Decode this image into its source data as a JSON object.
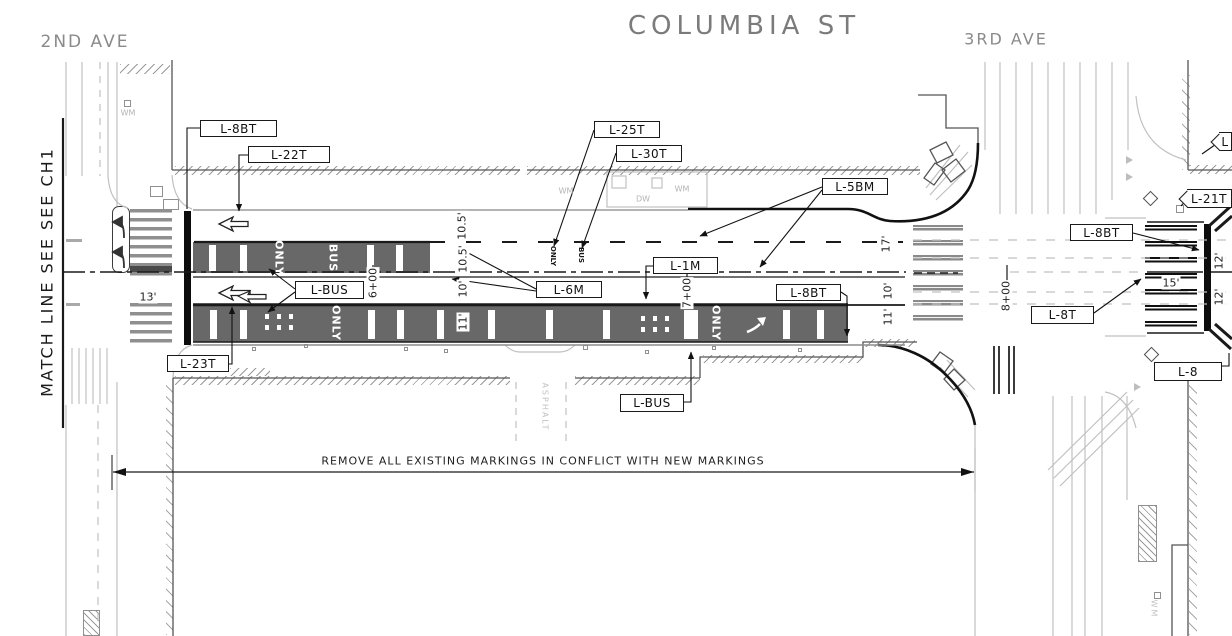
{
  "title": {
    "text": "COLUMBIA ST"
  },
  "streets": {
    "left": "2ND AVE",
    "right": "3RD AVE"
  },
  "match_line_label": "MATCH LINE SEE SEE CH1",
  "note": "REMOVE ALL EXISTING MARKINGS IN CONFLICT WITH NEW MARKINGS",
  "colors": {
    "ink": "#1a1a1a",
    "street_title_gray": "#7b7b7b",
    "existing_linework_gray": "#bcbcbc",
    "bus_lane_gray": "#686868",
    "paper": "#ffffff"
  },
  "marking_labels": [
    {
      "name": "label-l8bt-top",
      "shape": "rect",
      "text": "L-8BT",
      "x": 200,
      "y": 120,
      "w": 77,
      "h": 17
    },
    {
      "name": "label-l22t",
      "shape": "rect",
      "text": "L-22T",
      "x": 248,
      "y": 146,
      "w": 82,
      "h": 17
    },
    {
      "name": "label-l25t",
      "shape": "rect",
      "text": "L-25T",
      "x": 594,
      "y": 121,
      "w": 66,
      "h": 17
    },
    {
      "name": "label-l30t",
      "shape": "rect",
      "text": "L-30T",
      "x": 616,
      "y": 145,
      "w": 66,
      "h": 17
    },
    {
      "name": "label-l5bm",
      "shape": "rect",
      "text": "L-5BM",
      "x": 822,
      "y": 178,
      "w": 66,
      "h": 17
    },
    {
      "name": "label-l1m",
      "shape": "rect",
      "text": "L-1M",
      "x": 653,
      "y": 257,
      "w": 65,
      "h": 17
    },
    {
      "name": "label-l6m",
      "shape": "rect",
      "text": "L-6M",
      "x": 536,
      "y": 281,
      "w": 66,
      "h": 17
    },
    {
      "name": "label-lbus-mid",
      "shape": "rect",
      "text": "L-BUS",
      "x": 295,
      "y": 281,
      "w": 69,
      "h": 18
    },
    {
      "name": "label-l8bt-mid",
      "shape": "rect",
      "text": "L-8BT",
      "x": 776,
      "y": 284,
      "w": 65,
      "h": 17
    },
    {
      "name": "label-l23t",
      "shape": "rect",
      "text": "L-23T",
      "x": 167,
      "y": 355,
      "w": 62,
      "h": 17
    },
    {
      "name": "label-lbus-bottom",
      "shape": "rect",
      "text": "L-BUS",
      "x": 620,
      "y": 394,
      "w": 64,
      "h": 18
    },
    {
      "name": "label-l8bt-right",
      "shape": "rect",
      "text": "L-8BT",
      "x": 1070,
      "y": 224,
      "w": 63,
      "h": 17
    },
    {
      "name": "label-l8t",
      "shape": "rect",
      "text": "L-8T",
      "x": 1031,
      "y": 306,
      "w": 63,
      "h": 18
    },
    {
      "name": "label-l8",
      "shape": "rect",
      "text": "L-8",
      "x": 1154,
      "y": 362,
      "w": 68,
      "h": 19
    },
    {
      "name": "label-l21t-hex",
      "shape": "hex",
      "text": "L-21T",
      "x": 1187,
      "y": 189,
      "w": 45,
      "h": 19
    },
    {
      "name": "label-lhex-top",
      "shape": "hex",
      "text": "L",
      "x": 1219,
      "y": 132,
      "w": 13,
      "h": 19
    }
  ],
  "annotations": [
    {
      "name": "dim-10-5-a",
      "cls": "dim",
      "text": "10.5'",
      "x": 462,
      "y": 226
    },
    {
      "name": "dim-10-5-b",
      "cls": "dim",
      "text": "10.5'",
      "x": 463,
      "y": 259
    },
    {
      "name": "dim-10-a",
      "cls": "dim",
      "text": "10'",
      "x": 463,
      "y": 289
    },
    {
      "name": "dim-11-a",
      "cls": "dim",
      "text": "11'",
      "x": 463,
      "y": 322
    },
    {
      "name": "dim-17",
      "cls": "dim",
      "text": "17'",
      "x": 886,
      "y": 244
    },
    {
      "name": "dim-10-b",
      "cls": "dim",
      "text": "10'",
      "x": 888,
      "y": 291
    },
    {
      "name": "dim-11-b",
      "cls": "dim",
      "text": "11'",
      "x": 888,
      "y": 317
    },
    {
      "name": "dim-12-a",
      "cls": "dim",
      "text": "12'",
      "x": 1219,
      "y": 261
    },
    {
      "name": "dim-12-b",
      "cls": "dim",
      "text": "12'",
      "x": 1219,
      "y": 297
    },
    {
      "name": "dim-13",
      "cls": "dimh",
      "text": "13'",
      "x": 148,
      "y": 297
    },
    {
      "name": "dim-15",
      "cls": "dimh",
      "text": "15'",
      "x": 1171,
      "y": 283
    },
    {
      "name": "station-6",
      "cls": "sta",
      "text": "6+00",
      "x": 373,
      "y": 283
    },
    {
      "name": "station-7",
      "cls": "sta",
      "text": "7+00",
      "x": 687,
      "y": 293
    },
    {
      "name": "station-8",
      "cls": "sta",
      "text": "8+00",
      "x": 1006,
      "y": 296
    },
    {
      "name": "pavement-only-1",
      "cls": "lanetext",
      "text": "ONLY",
      "x": 279,
      "y": 258
    },
    {
      "name": "pavement-bus-1",
      "cls": "lanetext",
      "text": "BUS",
      "x": 333,
      "y": 258
    },
    {
      "name": "pavement-only-2",
      "cls": "lanetext",
      "text": "ONLY",
      "x": 336,
      "y": 323
    },
    {
      "name": "pavement-only-3",
      "cls": "lanetext",
      "text": "ONLY",
      "x": 716,
      "y": 323
    },
    {
      "name": "pavement-only-sm",
      "cls": "lanetext-sm",
      "text": "ONLY",
      "x": 553,
      "y": 256
    },
    {
      "name": "pavement-bus-sm",
      "cls": "lanetext-sm",
      "text": "BUS",
      "x": 581,
      "y": 255
    },
    {
      "name": "util-wm-1",
      "cls": "lt",
      "text": "WM",
      "x": 128,
      "y": 113
    },
    {
      "name": "util-wm-2",
      "cls": "lt",
      "text": "WM",
      "x": 566,
      "y": 191
    },
    {
      "name": "util-wm-3",
      "cls": "lt",
      "text": "WM",
      "x": 682,
      "y": 189
    },
    {
      "name": "util-dw",
      "cls": "lt",
      "text": "DW",
      "x": 643,
      "y": 199
    },
    {
      "name": "util-wm-4",
      "cls": "asphalt",
      "text": "WM",
      "x": 1154,
      "y": 609
    },
    {
      "name": "surface-asphalt",
      "cls": "asphalt",
      "text": "ASPHALT",
      "x": 545,
      "y": 407
    }
  ]
}
